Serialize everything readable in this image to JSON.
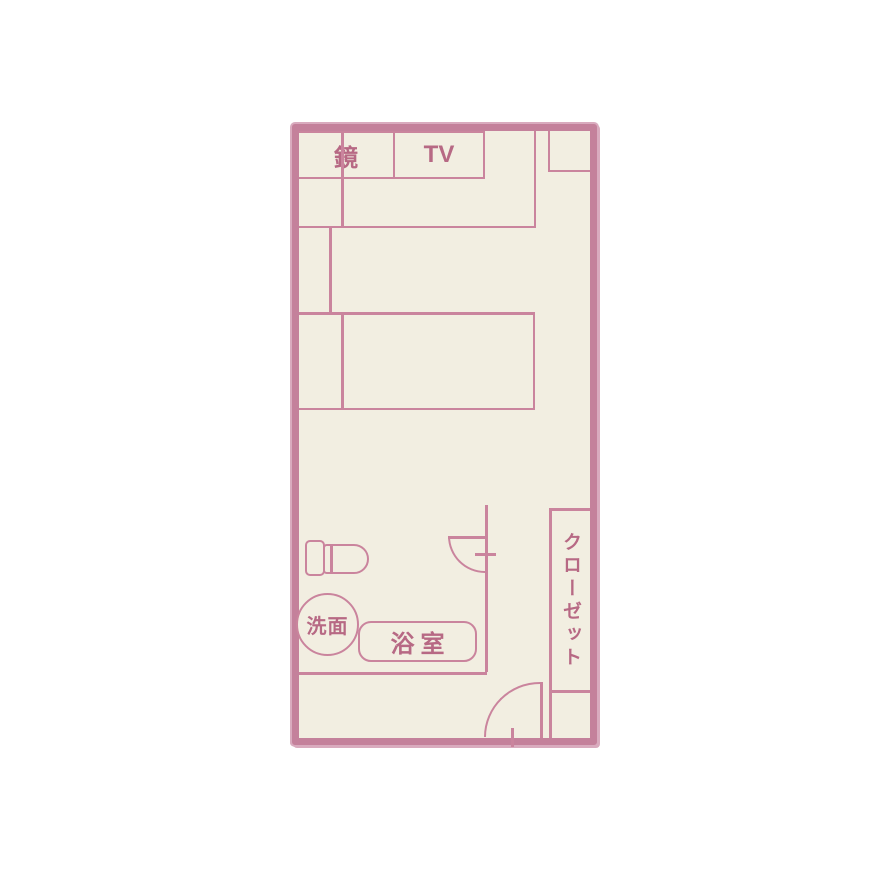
{
  "colors": {
    "background": "#ffffff",
    "floor": "#f2eee1",
    "wall": "#c4819b",
    "wall-soft": "#d9abbe",
    "line": "#ca849d",
    "text": "#b76984"
  },
  "floorplan": {
    "labels": {
      "mirror": "鏡",
      "tv": "TV",
      "washbasin": "洗面",
      "bathroom": "浴室",
      "closet": "クローゼット"
    }
  }
}
